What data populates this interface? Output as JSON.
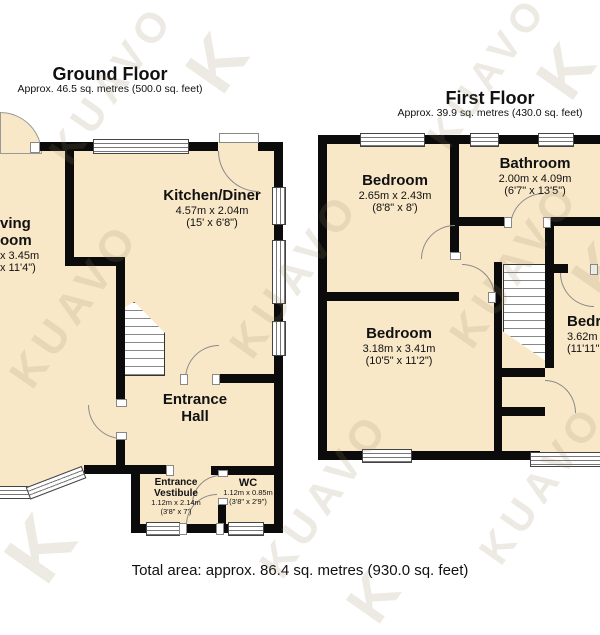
{
  "watermark": {
    "text": "KUAVO",
    "letter": "K"
  },
  "ground_floor": {
    "title": "Ground Floor",
    "subtitle": "Approx. 46.5 sq. metres (500.0 sq. feet)",
    "rooms": {
      "living_room": {
        "name_line1": "ving",
        "name_line2": "oom",
        "dims": "x 3.45m",
        "dims_ft": "x 11'4\")"
      },
      "kitchen_diner": {
        "name": "Kitchen/Diner",
        "dims": "4.57m x 2.04m",
        "dims_ft": "(15' x 6'8\")"
      },
      "entrance_hall": {
        "name_line1": "Entrance",
        "name_line2": "Hall"
      },
      "entrance_vestibule": {
        "name_line1": "Entrance",
        "name_line2": "Vestibule",
        "dims": "1.12m x 2.14m",
        "dims_ft": "(3'8\" x 7')"
      },
      "wc": {
        "name": "WC",
        "dims": "1.12m x 0.85m",
        "dims_ft": "(3'8\" x 2'9\")"
      }
    }
  },
  "first_floor": {
    "title": "First Floor",
    "subtitle": "Approx. 39.9 sq. metres (430.0 sq. feet)",
    "rooms": {
      "bedroom_1": {
        "name": "Bedroom",
        "dims": "2.65m x 2.43m",
        "dims_ft": "(8'8\" x 8')"
      },
      "bathroom": {
        "name": "Bathroom",
        "dims": "2.00m x 4.09m",
        "dims_ft": "(6'7\" x 13'5\")"
      },
      "bedroom_2": {
        "name": "Bedroom",
        "dims": "3.18m x 3.41m",
        "dims_ft": "(10'5\" x 11'2\")"
      },
      "bedroom_3": {
        "name": "Bedr",
        "dims": "3.62m x",
        "dims_ft": "(11'11\""
      }
    }
  },
  "footer": {
    "total_area": "Total area: approx. 86.4 sq. metres (930.0 sq. feet)"
  },
  "colors": {
    "floor_fill": "#F8E8C8",
    "wall": "#0B0B0B",
    "watermark_tint": "#96845F"
  }
}
